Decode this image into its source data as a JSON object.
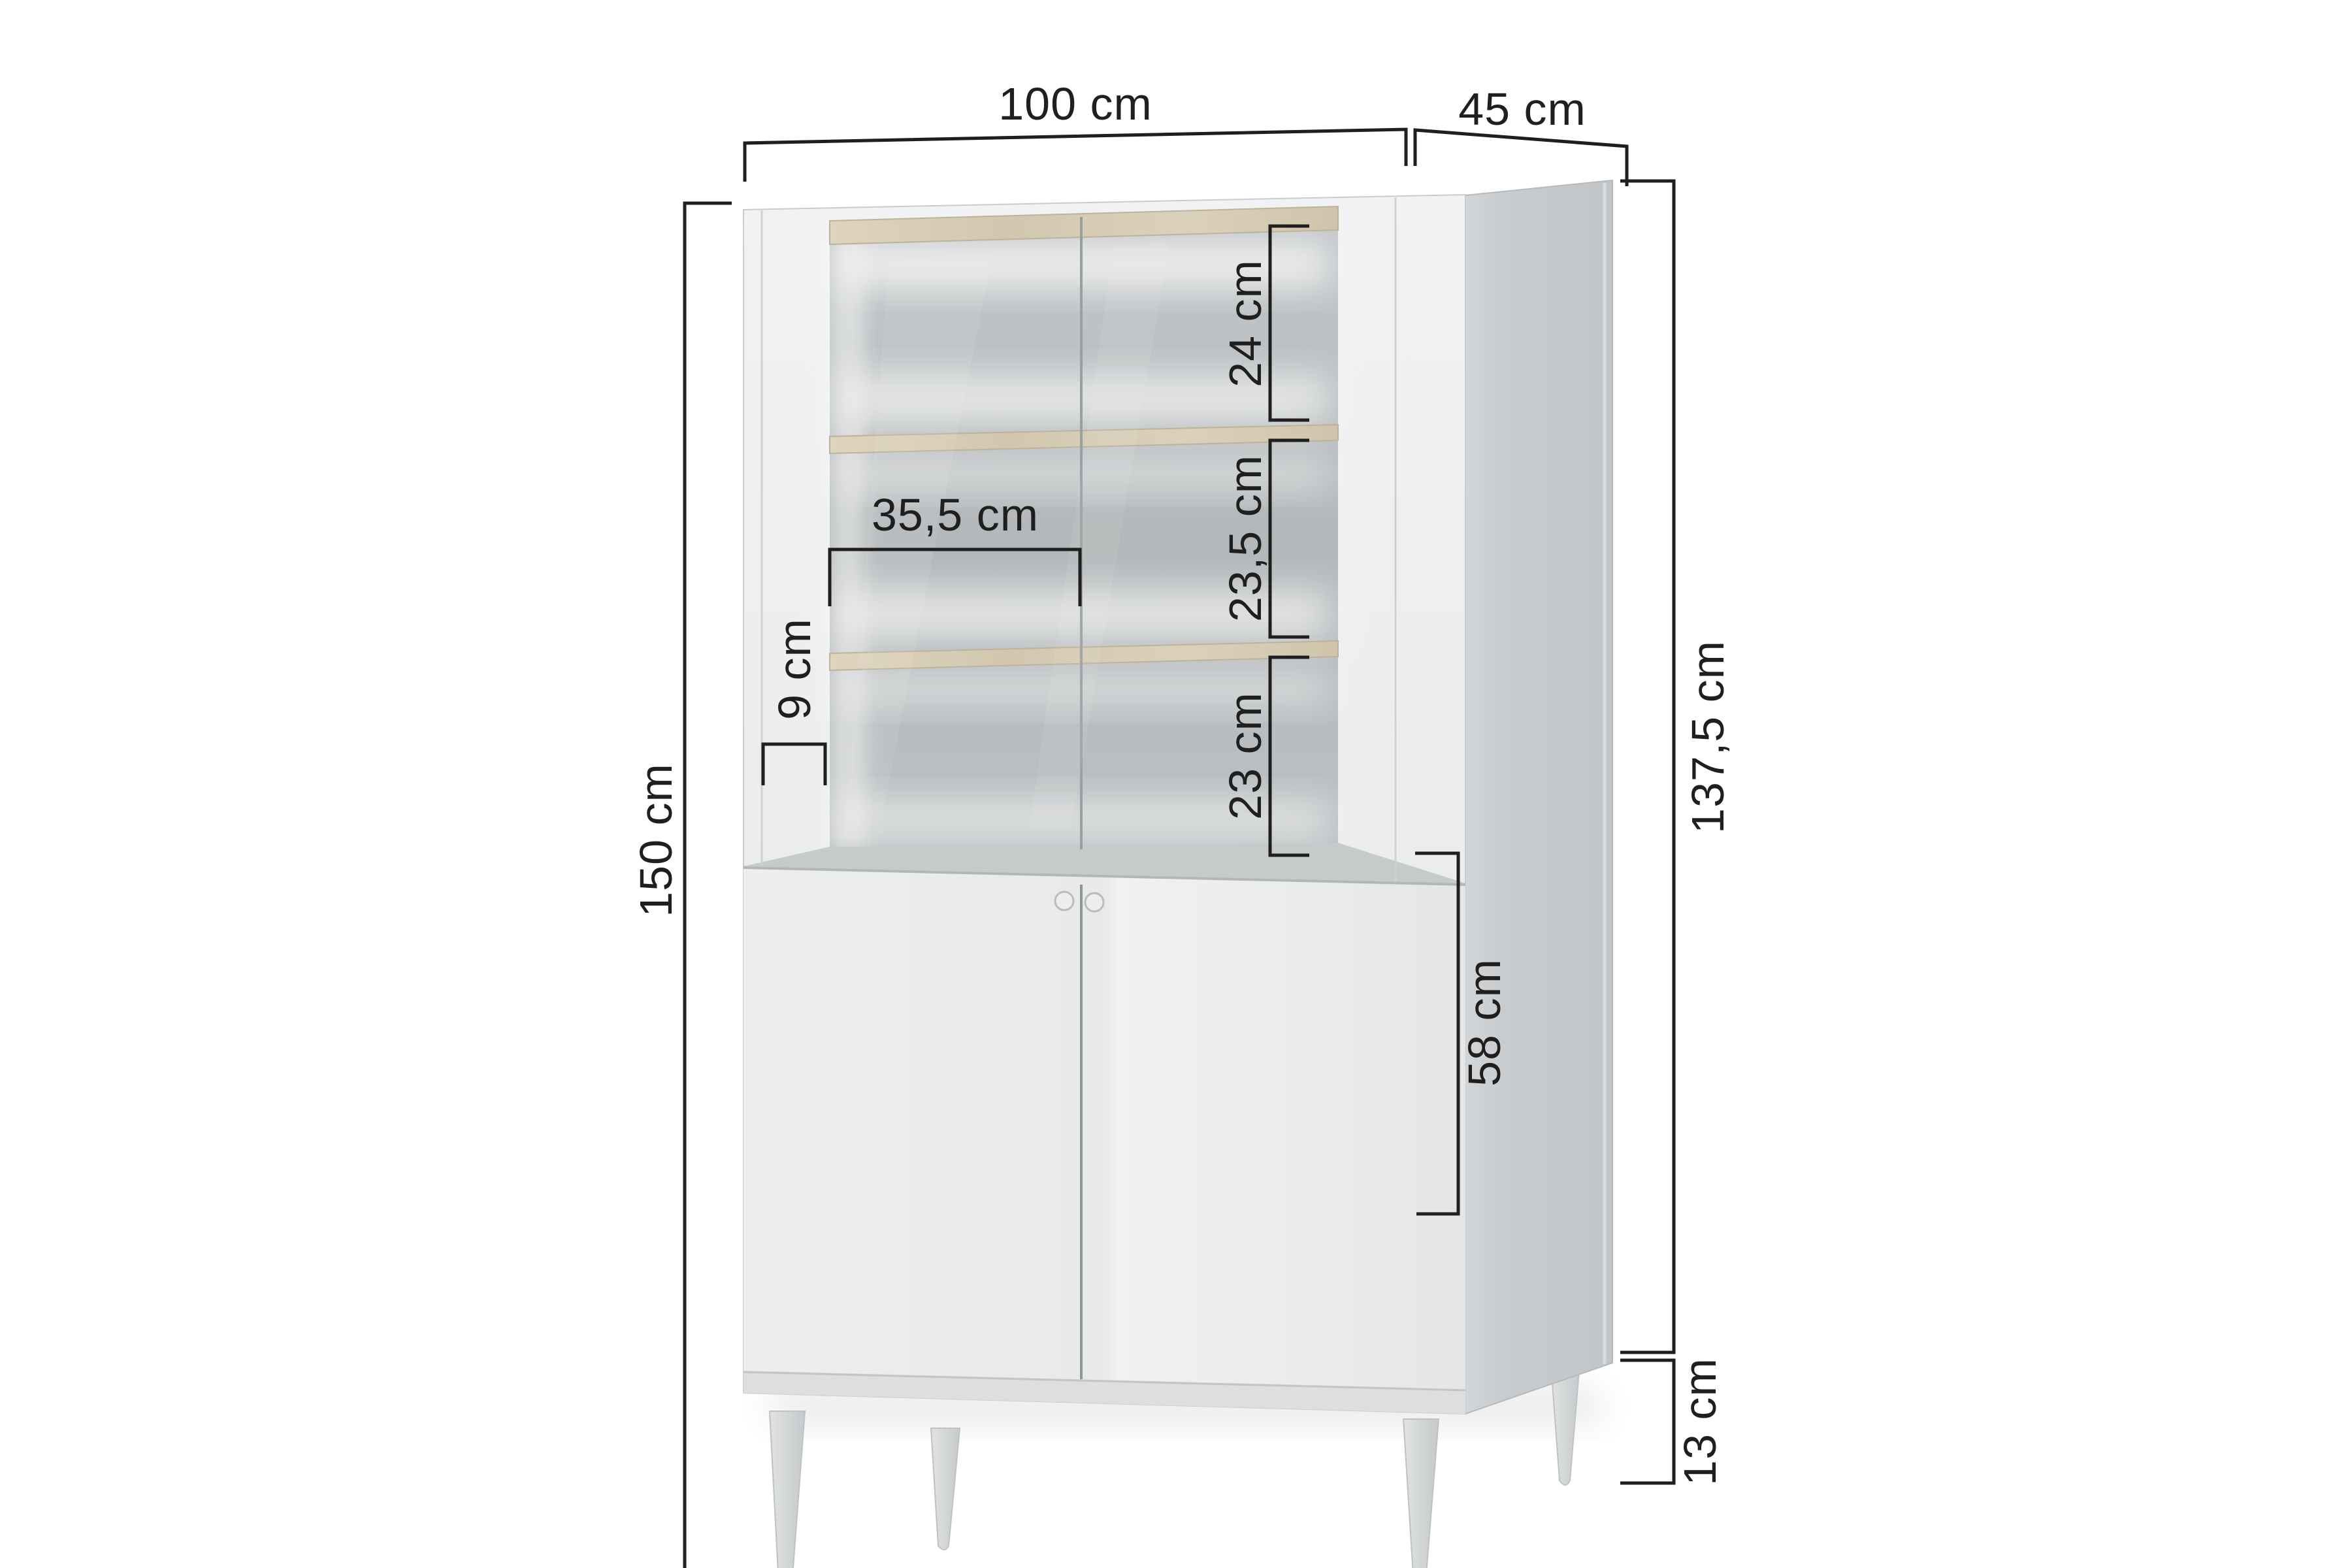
{
  "figure": {
    "type": "furniture-dimension-diagram",
    "product": "display-cabinet-with-shelves-and-doors",
    "units": "cm",
    "colors": {
      "dimension_line": "#1f1f1f",
      "label_text": "#1f1f1f",
      "cabinet_front": "#eceeef",
      "cabinet_side": "#c7cacc",
      "interior_back": "#b7bbbd",
      "shelf_wood": "#d8cdb6",
      "legs": "#d6d9da",
      "background": "#ffffff"
    },
    "dimensions": {
      "width": {
        "label": "100 cm",
        "value": 100
      },
      "depth": {
        "label": "45 cm",
        "value": 45
      },
      "total_height": {
        "label": "150 cm",
        "value": 150
      },
      "body_height": {
        "label": "137,5 cm",
        "value": 137.5
      },
      "lower_cabinet_height": {
        "label": "58 cm",
        "value": 58
      },
      "leg_height": {
        "label": "13 cm",
        "value": 13
      },
      "top_shelf_space": {
        "label": "24 cm",
        "value": 24
      },
      "middle_shelf_space": {
        "label": "23,5 cm",
        "value": 23.5
      },
      "bottom_shelf_space": {
        "label": "23 cm",
        "value": 23
      },
      "inner_shelf_width": {
        "label": "35,5 cm",
        "value": 35.5
      },
      "frame_pillar_width": {
        "label": "9 cm",
        "value": 9
      }
    }
  }
}
